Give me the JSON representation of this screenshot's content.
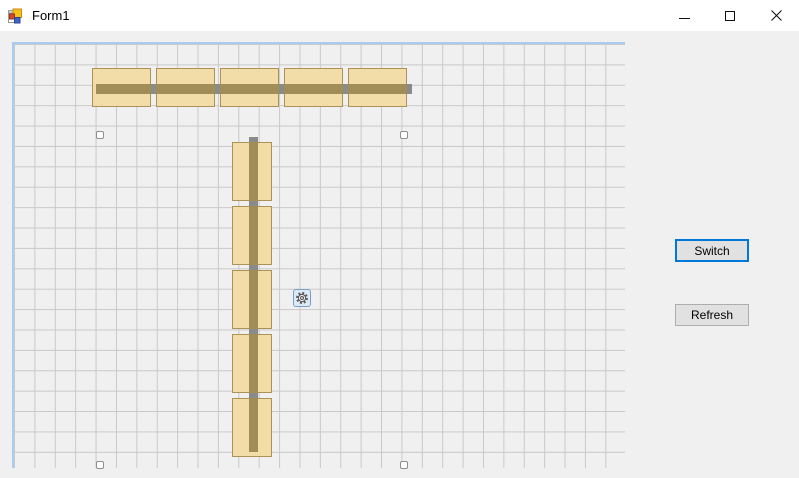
{
  "window": {
    "title": "Form1",
    "controls": [
      {
        "name": "minimize"
      },
      {
        "name": "maximize"
      },
      {
        "name": "close"
      }
    ]
  },
  "colors": {
    "titlebar_bg": "#FFFFFF",
    "client_bg": "#F0F0F0",
    "panel_border": "#A9CCF2",
    "grid_line": "#C9C9C9",
    "block_fill": "#F2DCA7",
    "block_border": "#AD9157",
    "belt_brown": "#A18D58",
    "belt_gray": "#8A8A8A",
    "sensor_fill": "#FDFDFD",
    "sensor_border": "#8F8F8F",
    "focus_blue": "#0078D7",
    "button_face": "#E1E1E1",
    "button_border": "#ADADAD",
    "gear_bg": "#DCE9F6",
    "gear_border": "#7A9CC6"
  },
  "panel": {
    "x": 12,
    "y": 42,
    "w": 613,
    "h": 426,
    "grid_cell": 20.4
  },
  "scene": {
    "h_blocks": {
      "y": 68,
      "w": 59,
      "h": 39,
      "xs": [
        92,
        156,
        220,
        284,
        348
      ]
    },
    "v_blocks": {
      "x": 232,
      "w": 40,
      "h": 59,
      "ys": [
        142,
        206,
        270,
        334,
        398
      ]
    },
    "h_belt_base": {
      "x": 96,
      "y": 84,
      "w": 316,
      "h": 10
    },
    "h_belt_brown": {
      "y": 84,
      "h": 10,
      "spans": [
        [
          96,
          55
        ],
        [
          156,
          59
        ],
        [
          220,
          59
        ],
        [
          284,
          59
        ],
        [
          348,
          59
        ]
      ]
    },
    "v_belt_base": {
      "x": 249,
      "y": 137,
      "w": 9,
      "h": 315
    },
    "v_belt_brown": {
      "x": 249,
      "w": 9,
      "spans": [
        [
          142,
          59
        ],
        [
          206,
          59
        ],
        [
          270,
          59
        ],
        [
          334,
          59
        ],
        [
          398,
          54
        ]
      ]
    },
    "sensors": {
      "size": 8,
      "positions": [
        [
          96,
          131
        ],
        [
          400,
          131
        ],
        [
          96,
          461
        ],
        [
          400,
          461
        ]
      ]
    },
    "gear": {
      "x": 293,
      "y": 289,
      "size": 18
    }
  },
  "side_panel": {
    "switch_button": {
      "label": "Switch",
      "x": 675,
      "y": 239,
      "w": 74,
      "h": 23,
      "focused": true
    },
    "refresh_button": {
      "label": "Refresh",
      "x": 675,
      "y": 304,
      "w": 74,
      "h": 22,
      "focused": false
    }
  }
}
